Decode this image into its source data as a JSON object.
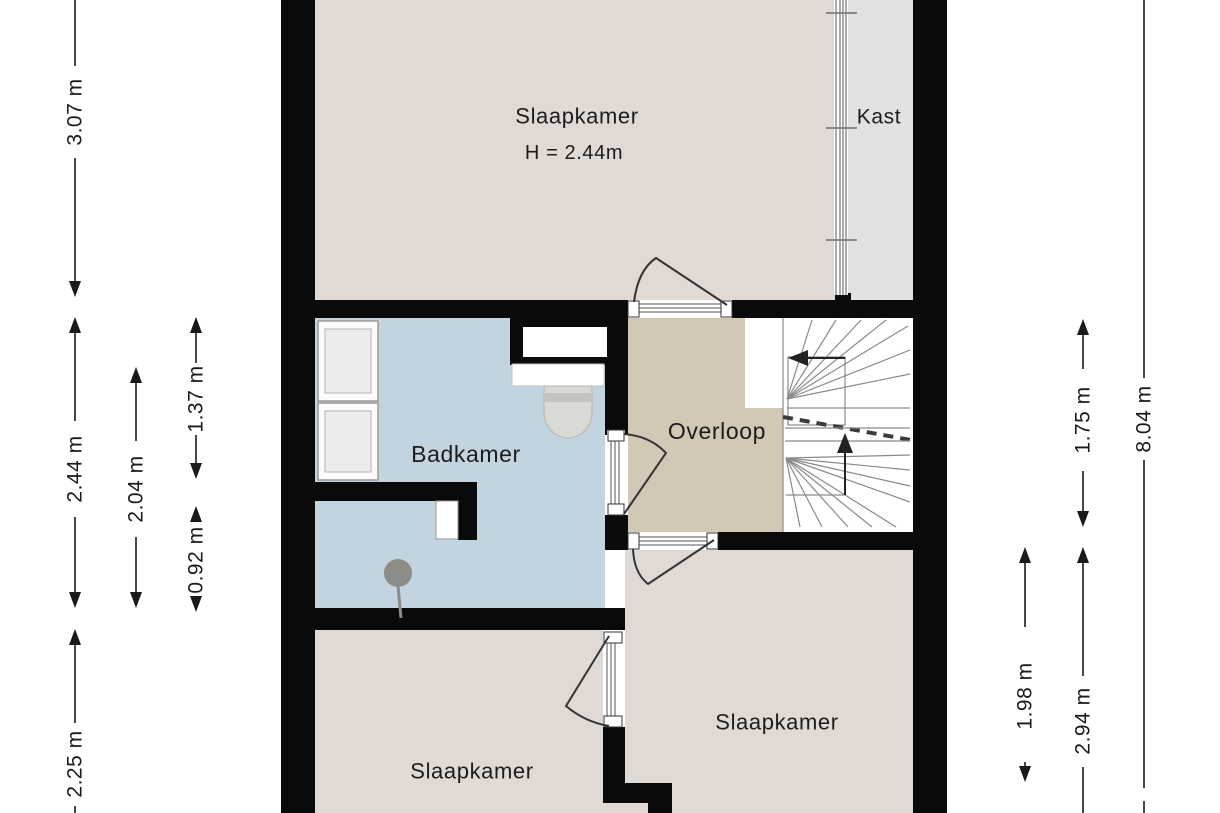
{
  "floorplan": {
    "colors": {
      "wall": "#0a0a0a",
      "bedroom": "#e1d9d3",
      "closet": "#dfe2df",
      "bathroom": "#c3d4e1",
      "landing": "#d3c7b5",
      "stairs": "#ffffff",
      "fixture": "#d9d9d5",
      "shower": "#8c8c86"
    },
    "rooms": {
      "top_bedroom": {
        "label": "Slaapkamer",
        "ceiling_height": "H = 2.44m"
      },
      "closet": {
        "label": "Kast"
      },
      "bathroom": {
        "label": "Badkamer"
      },
      "landing": {
        "label": "Overloop"
      },
      "right_bedroom": {
        "label": "Slaapkamer"
      },
      "left_bedroom": {
        "label": "Slaapkamer"
      }
    },
    "dimensions": {
      "left": [
        "3.07 m",
        "2.44 m",
        "2.04 m",
        "1.37 m",
        "0.92 m",
        "2.25 m"
      ],
      "right": [
        "1.75 m",
        "8.04 m",
        "1.98 m",
        "2.94 m"
      ]
    }
  }
}
